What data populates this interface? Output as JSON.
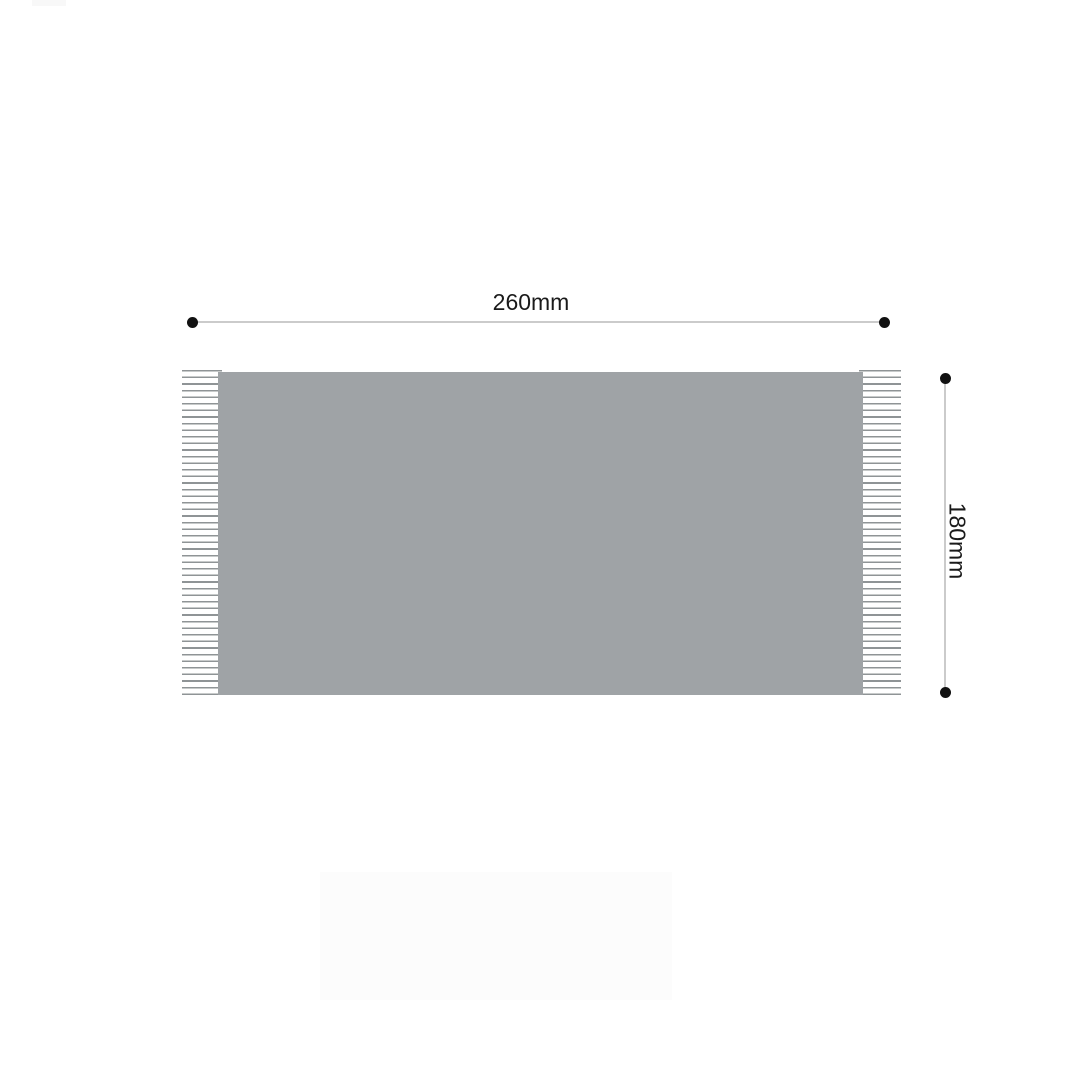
{
  "dimensions": {
    "width": {
      "label": "260mm",
      "value": 260,
      "unit": "mm"
    },
    "height": {
      "label": "180mm",
      "value": 180,
      "unit": "mm"
    }
  },
  "colors": {
    "background": "#ffffff",
    "product-gray": "#9fa3a6",
    "fringe-line": "#8f9496",
    "dimension-line": "#cbcbcb",
    "dimension-dot": "#111111",
    "label-text": "#1a1a1a",
    "shadow-gray": "#fcfcfc"
  }
}
